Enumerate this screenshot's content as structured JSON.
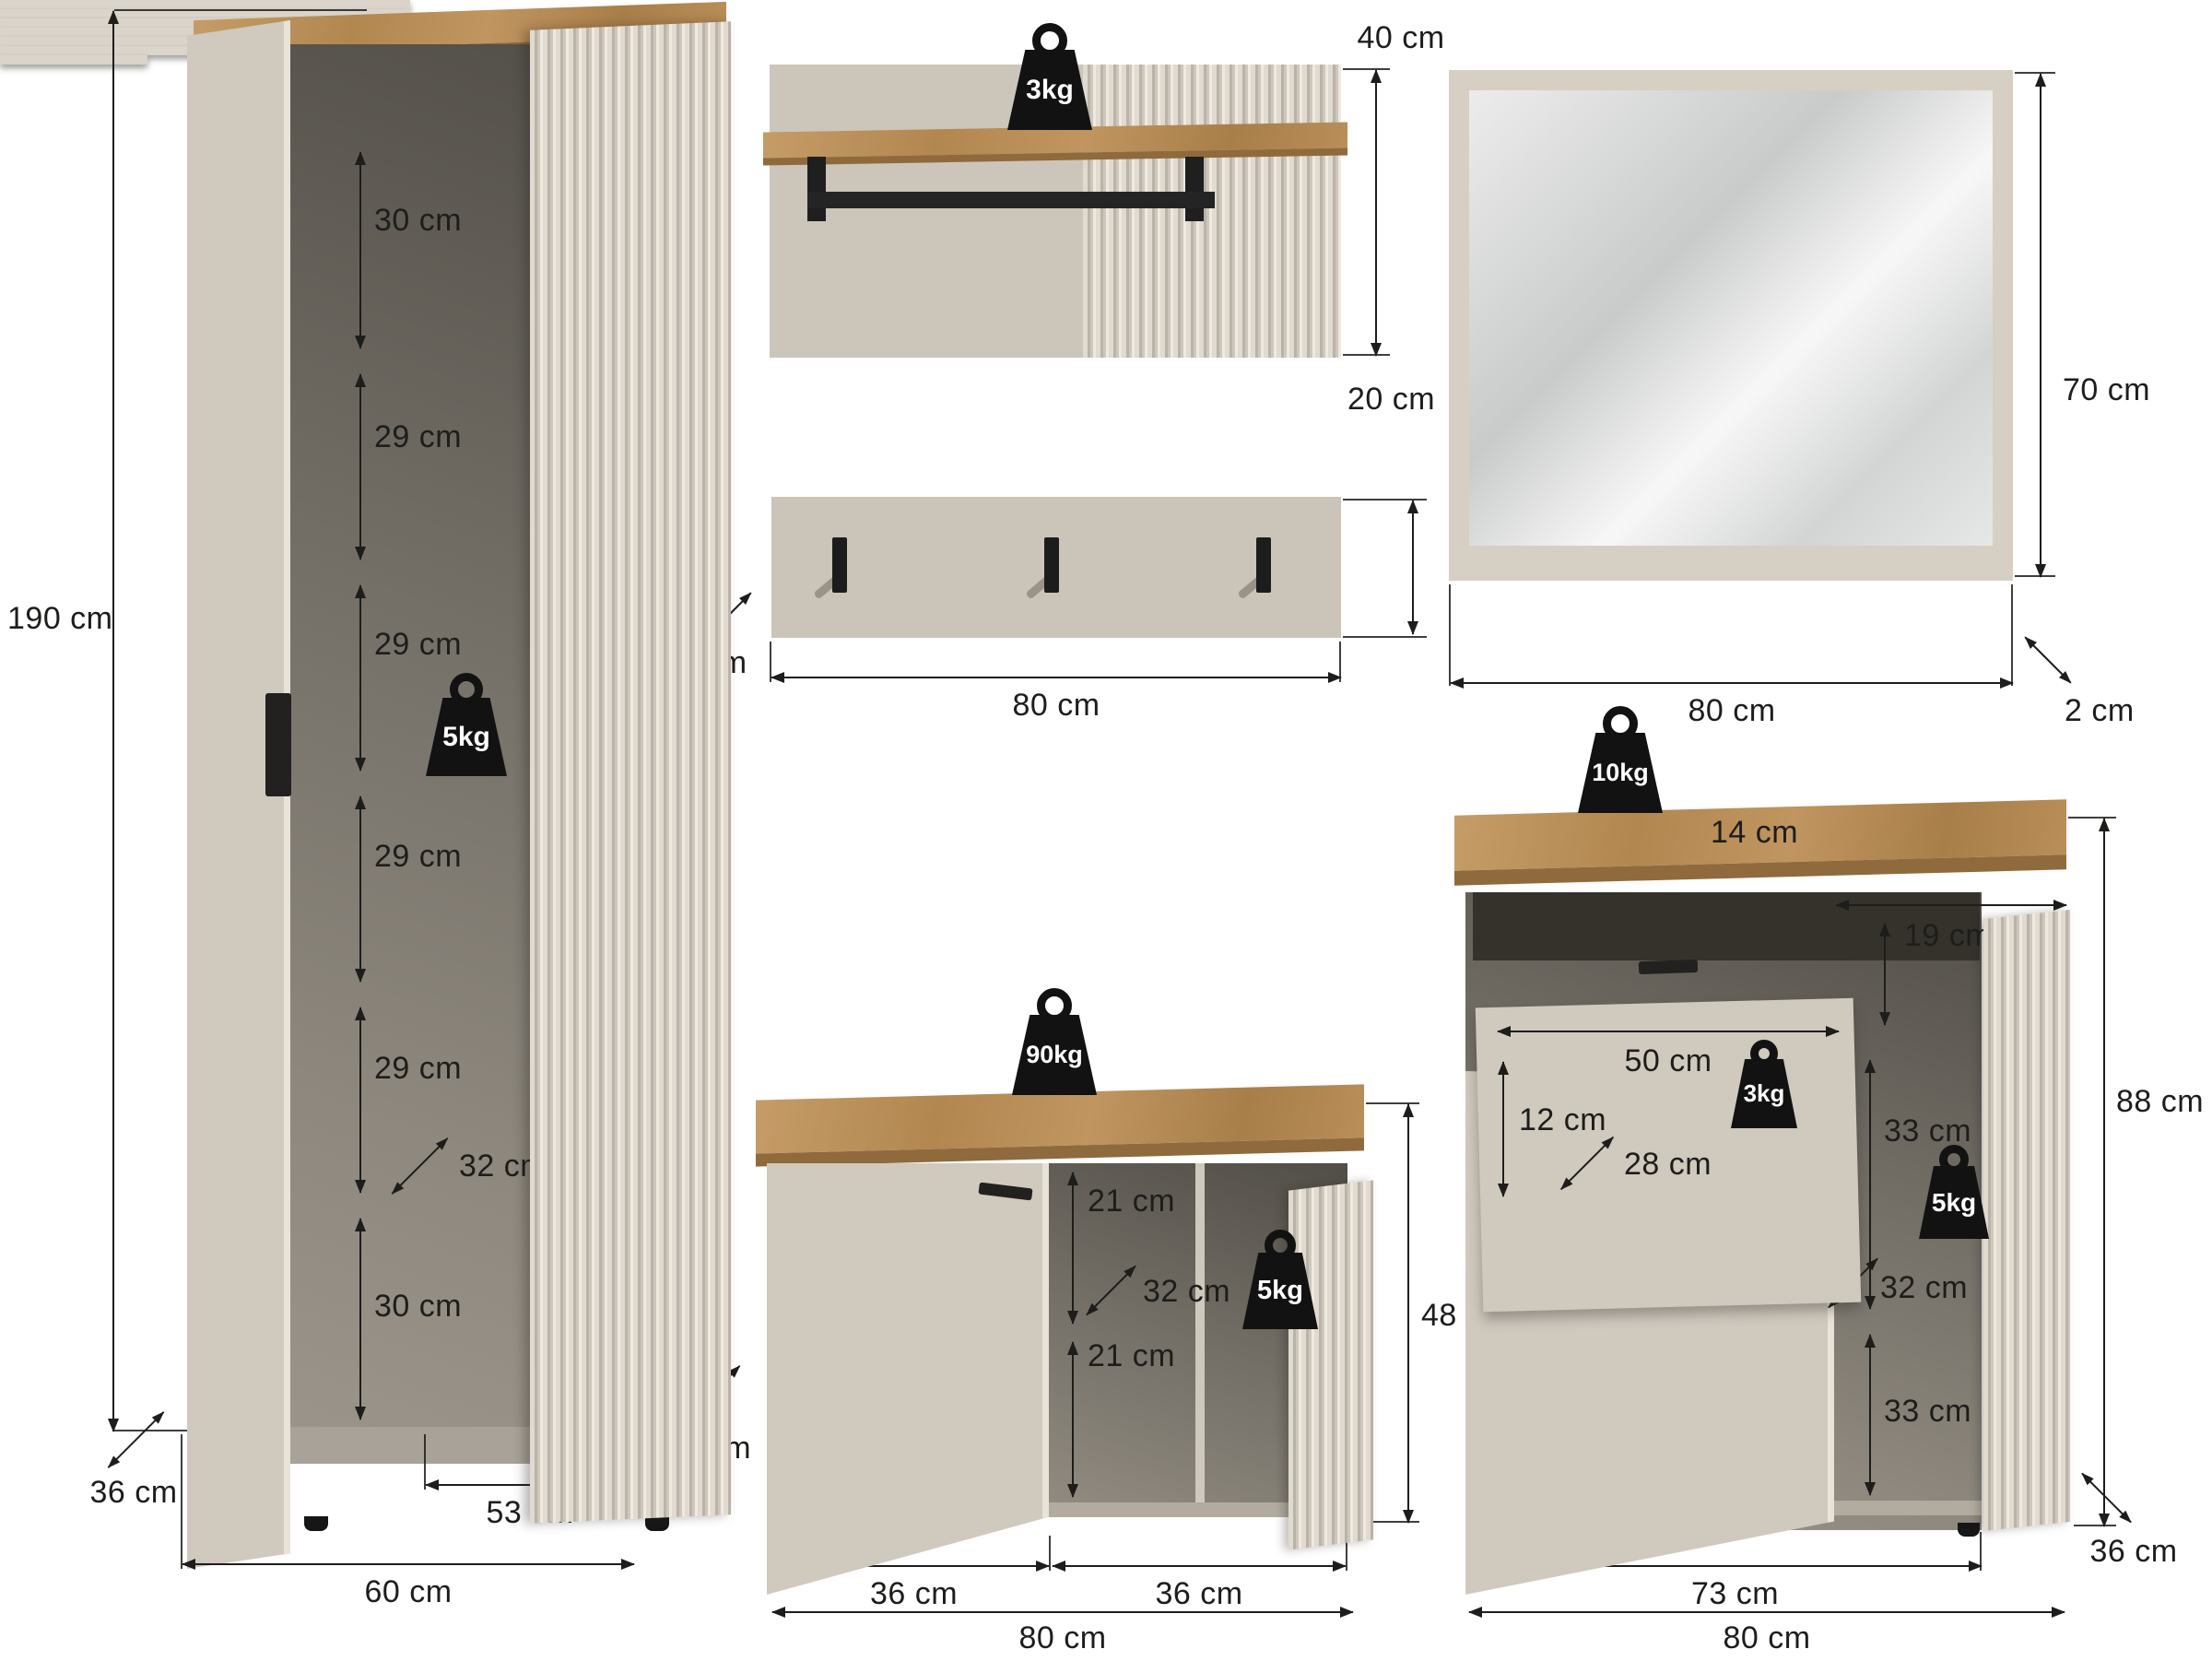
{
  "palette": {
    "line_and_icon_black": "#1d1d1b",
    "panel_beige": "#ccc5ba",
    "fluted_beige": "#d8d2c8",
    "oak_wood": "#b98e58",
    "interior_grey": "#6e6a62",
    "background": "#ffffff"
  },
  "icons": {
    "weight": "weight-kettlebell-icon",
    "arrows": "dimension-arrow"
  },
  "wardrobe": {
    "height": "190 cm",
    "compartments": [
      "30 cm",
      "29 cm",
      "29 cm",
      "29 cm",
      "29 cm",
      "30 cm"
    ],
    "inner_depth": "32 cm",
    "shelf_capacity": "5kg",
    "depth": "36 cm",
    "inner_width": "53 cm",
    "width": "60 cm"
  },
  "wall_shelf": {
    "capacity": "3kg",
    "height": "40 cm"
  },
  "hook_panel": {
    "height": "20 cm",
    "depth": "28 cm",
    "width": "80 cm"
  },
  "mirror": {
    "height": "70 cm",
    "width": "80 cm",
    "depth": "2 cm"
  },
  "bench": {
    "top_capacity": "90kg",
    "shelf_capacity": "5kg",
    "upper_gap": "21 cm",
    "inner_depth": "32 cm",
    "lower_gap": "21 cm",
    "height": "48 cm",
    "depth": "36 cm",
    "doors": [
      "36 cm",
      "36 cm"
    ],
    "width": "80 cm"
  },
  "cabinet": {
    "top_capacity": "10kg",
    "top_rail": "14 cm",
    "drawer_width": "50 cm",
    "drawer_height": "12 cm",
    "drawer_depth": "28 cm",
    "drawer_capacity": "3kg",
    "drawer_side_gap": "19 cm",
    "shelf_gaps": [
      "33 cm",
      "33 cm"
    ],
    "shelf_capacity": "5kg",
    "inner_depth": "32 cm",
    "height": "88 cm",
    "depth": "36 cm",
    "inner_width": "73 cm",
    "width": "80 cm"
  }
}
